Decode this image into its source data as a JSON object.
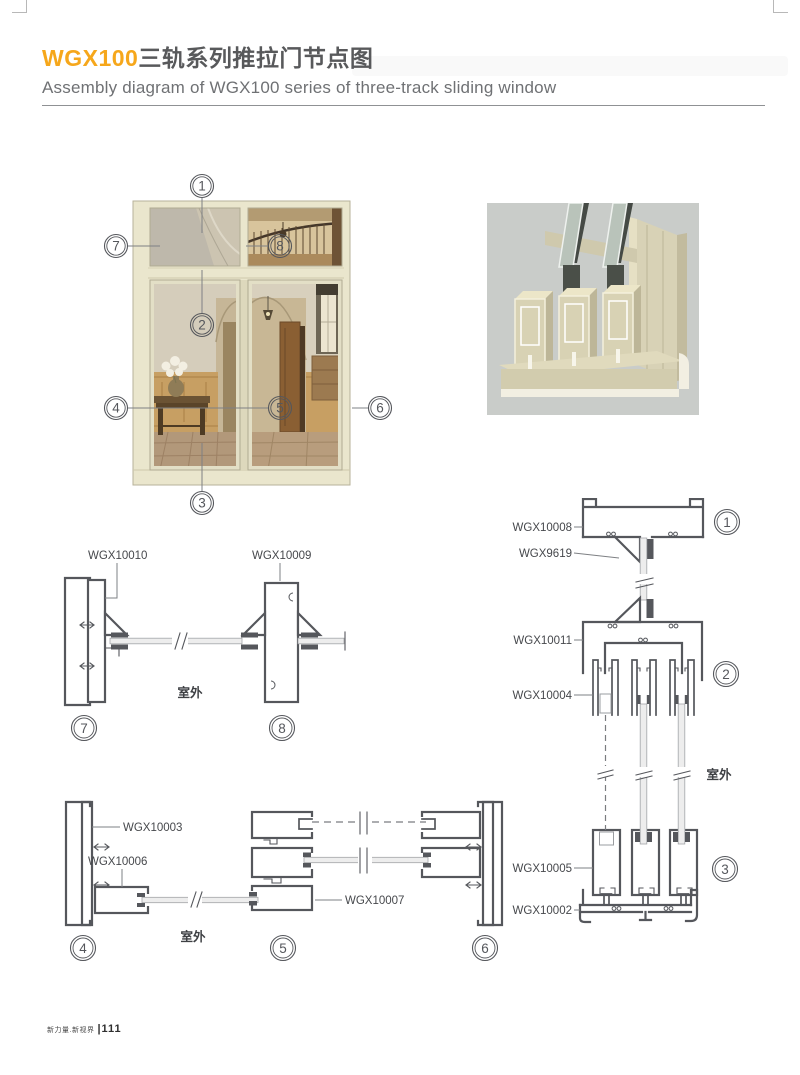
{
  "header": {
    "title_highlight": "WGX100",
    "title_zh": "三轨系列推拉门节点图",
    "subtitle": "Assembly diagram of WGX100 series of three-track sliding window"
  },
  "footer": {
    "brand": "新力量.新视界",
    "separator": "|",
    "page_number": "111"
  },
  "labels": {
    "outdoor": "室外"
  },
  "photo_callouts": {
    "c1": "1",
    "c2": "2",
    "c3": "3",
    "c4": "4",
    "c5": "5",
    "c6": "6",
    "c7": "7",
    "c8": "8"
  },
  "detail_78": {
    "left_profile": "WGX10010",
    "right_profile": "WGX10009",
    "callout_left": "7",
    "callout_right": "8"
  },
  "vertical_section": {
    "top_frame": "WGX10008",
    "glazing_clamp": "WGX9619",
    "transom": "WGX10011",
    "sash_top": "WGX10004",
    "sash_bottom": "WGX10005",
    "bottom_track": "WGX10002",
    "callout_top": "1",
    "callout_mid": "2",
    "callout_bottom": "3"
  },
  "horizontal_section": {
    "jamb": "WGX10003",
    "sash": "WGX10006",
    "interlock": "WGX10007",
    "callout_left": "4",
    "callout_mid": "5",
    "callout_right": "6"
  },
  "colors": {
    "accent": "#F6A71B",
    "line": "#55575C",
    "frame_cream": "#EAE6CD"
  }
}
